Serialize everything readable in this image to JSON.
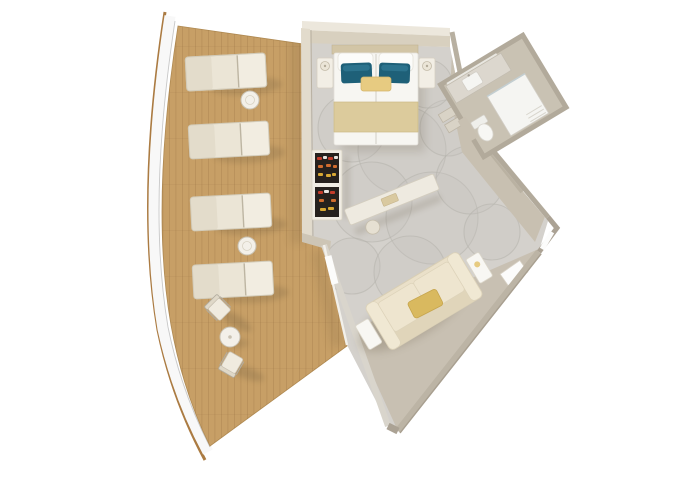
{
  "scene": {
    "type": "cruise-suite-floorplan-3d-top-view",
    "rooms": [
      "balcony-deck",
      "bedroom",
      "living-area",
      "bathroom",
      "hallway-entry"
    ],
    "balcony": {
      "sun_loungers": 4,
      "lounger_side_tables": 2,
      "bistro_chairs": 2,
      "bistro_tables": 1
    },
    "bedroom": {
      "beds": 1,
      "white_pillows": 2,
      "teal_pillows": 2,
      "accent_pillows": 1,
      "nightstands": 2,
      "lamps": 2,
      "open_wardrobes": 1,
      "console_desks": 1,
      "stools": 1
    },
    "living_area": {
      "sofas": 1,
      "gold_pillows": 1,
      "sofa_side_tables": 2
    },
    "bathroom": {
      "vanity_sinks": 1,
      "showers": 1,
      "toilets": 1
    },
    "hallway": {
      "entry_doors": 1,
      "luggage_benches": 1
    }
  },
  "palette": {
    "bg": "#ffffff",
    "hull": "#ab7b42",
    "promenade": "#f8f8f8",
    "promenade_line": "#c8c8c8",
    "deck": "#c79f66",
    "plank": "#8c6437",
    "shadow": "#574a33",
    "lounger_body": "#ebe5d6",
    "lounger_back": "#f2ede1",
    "lounger_foot": "#e3dccb",
    "lounger_stroke": "#d2cbb9",
    "table_top": "#f3f0e9",
    "table_stroke": "#c9c2b3",
    "chair_seat": "#f0ebdf",
    "chair_back": "#dfd8c8",
    "chair_stroke": "#b2ac9f",
    "carpet": "#d4d1cc",
    "carpet_circle": "#b5b2ab",
    "taupe_floor": "#c7bfb0",
    "hall_floor": "#c8c0b1",
    "wall_top": "#ece7dc",
    "wall_face": "#d8d0bf",
    "wall_left": "#e2dbcc",
    "wall_band": "#b8b0a1",
    "wall_dark": "#a89f90",
    "glass_wall": "#d9d5cc",
    "glass_frame": "#f2f0ea",
    "door_white": "#fcfcfb",
    "bed_headboard": "#d2c5a6",
    "bed_duvet": "#f7f6f2",
    "bed_split": "#dcd9d2",
    "pillow_white": "#fcfcfa",
    "pillow_stroke": "#e5e2da",
    "pillow_teal": "#1e6078",
    "pillow_teal_hi": "#35809b",
    "bed_runner": "#dccb9c",
    "runner_edge": "#cbb987",
    "gold": "#e7cb81",
    "gold_deep": "#d9b95f",
    "gold_stroke": "#c6a54d",
    "nightstand": "#f2eee5",
    "nightstand_stroke": "#d6d0c2",
    "lamp": "#ebe5d7",
    "lamp_stroke": "#c3bba9",
    "wardrobe_frame": "#f0ece3",
    "wardrobe_dark": "#26211d",
    "cloth_red": "#c43c2a",
    "cloth_white": "#e8e5e0",
    "cloth_orange": "#d06c2e",
    "cloth_yellow": "#d8a833",
    "console": "#eeeae0",
    "console_stroke": "#d3cdbf",
    "sofa_base": "#eae0c9",
    "sofa_back": "#e0d5ba",
    "sofa_arm": "#f0e8d3",
    "sofa_cushion": "#eee5cf",
    "sofa_stroke": "#d8ceb4",
    "side_table": "#f8f7f3",
    "side_table_stroke": "#dcd7ca",
    "bath_floor": "#c9c2b3",
    "bath_wall": "#b2aa9b",
    "bath_counter": "#dcd7ce",
    "fixture": "#f5f5f2",
    "fixture_stroke": "#d2cec6",
    "shower_glass": "#c3ced1",
    "bench": "#d9d3c6",
    "bench_stroke": "#bdb5a6"
  }
}
